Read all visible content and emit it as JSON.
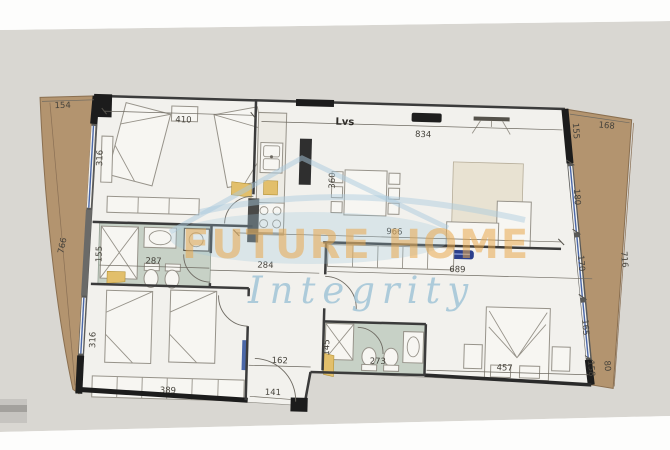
{
  "document": {
    "kind": "apartment-floor-plan-photo"
  },
  "rooms": {
    "living_label": "Lvs"
  },
  "dims": {
    "left_balcony_width": "154",
    "left_balcony_length": "766",
    "bedroom1_width": "410",
    "bedroom1_depth": "316",
    "living_top": "834",
    "right_wall_seg1": "155",
    "right_wall_seg2": "180",
    "right_wall_seg3": "170",
    "right_wall_seg4": "165",
    "right_wall_seg5": "158",
    "right_balcony_top": "168",
    "right_balcony_length": "716",
    "right_balcony_bottom": "80",
    "dining_depth": "360",
    "living_width": "966",
    "master_width": "689",
    "hall_width": "284",
    "bath1_width": "287",
    "bath1_shower": "155",
    "bedroom2_depth": "316",
    "bedroom2_width": "389",
    "hall2_width": "162",
    "entry_door": "141",
    "bath2_shower": "145",
    "bath2_width": "273",
    "master_room_width": "457"
  },
  "watermark": {
    "brand": "FUTURE HOME",
    "tagline": "Integrity"
  },
  "colors": {
    "paper": "#d9d7d2",
    "plan_floor": "#f2f1ed",
    "balcony": "#b3946f",
    "bathroom_floor": "#c7d1c6",
    "wall": "#3b3b3b",
    "window_blue": "#4a67a8",
    "door_leaf": "#e2bf6b",
    "ac_navy": "#2b3f8c",
    "watermark_orange": "#e9a94e",
    "watermark_blue": "#9cc2d6"
  }
}
